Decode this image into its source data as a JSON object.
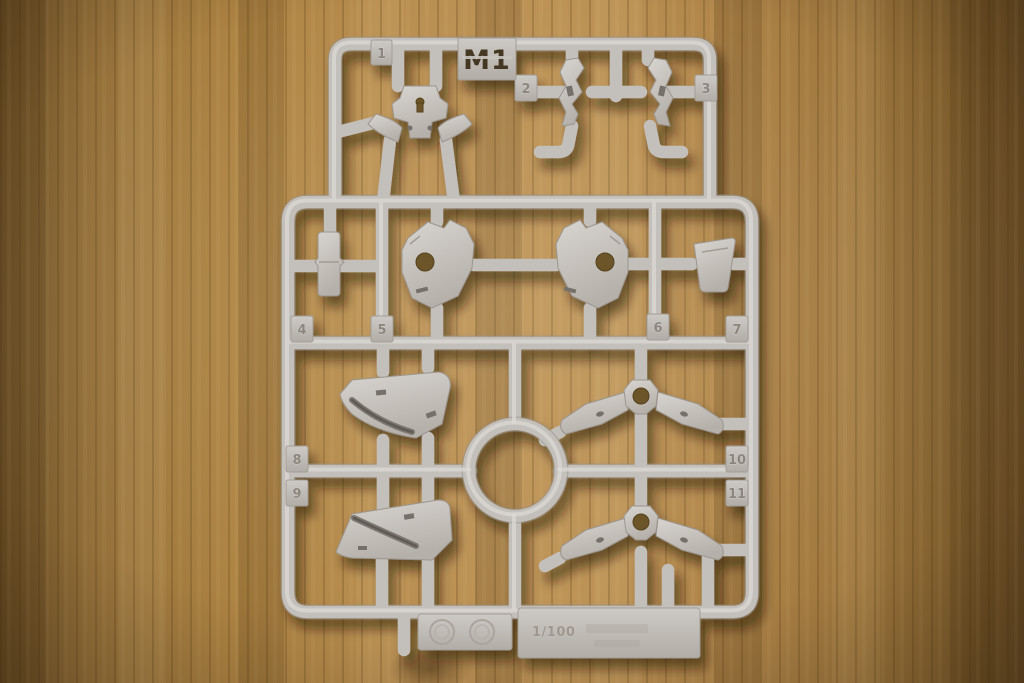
{
  "photo": {
    "description": "Light-gray plastic model kit runner (sprue) photographed on a wooden table"
  },
  "sprue": {
    "gate_label": "M1",
    "part_numbers": [
      "1",
      "2",
      "3",
      "4",
      "5",
      "6",
      "7",
      "8",
      "9",
      "10",
      "11"
    ],
    "plates": {
      "scale_text": "1/100"
    },
    "colors": {
      "plastic": "#c3bfba",
      "plastic_highlight": "#dcd8d3",
      "plastic_shadow": "#958f88",
      "stencil_text": "#453723",
      "wood_light": "#bd9356",
      "wood_mid": "#9c753c",
      "wood_dark": "#4f3b1c"
    }
  }
}
